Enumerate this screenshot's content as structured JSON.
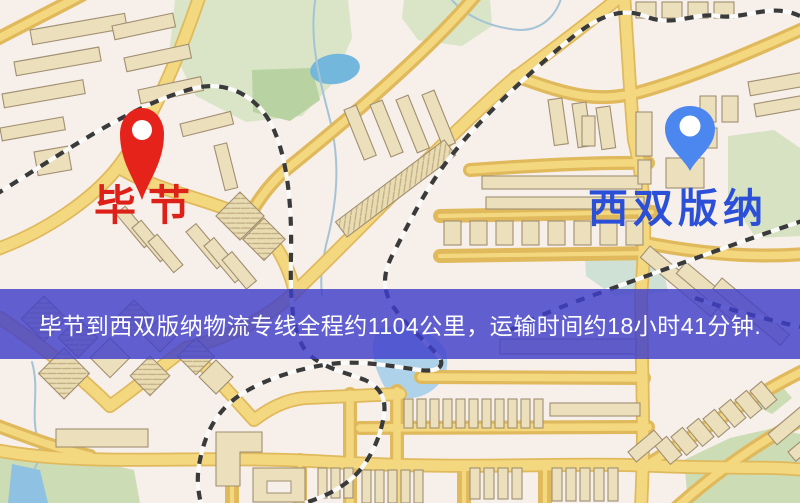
{
  "map": {
    "type": "road-map-screenshot",
    "banner": {
      "text": "毕节到西双版纳物流专线全程约1104公里，运输时间约18小时41分钟."
    },
    "markers": [
      {
        "id": "origin",
        "label": "毕节",
        "pin_icon": "red-map-pin"
      },
      {
        "id": "destination",
        "label": "西双版纳",
        "pin_icon": "blue-map-pin"
      }
    ],
    "css_vars": {
      "map-bg": "#f7efe9",
      "banner-bg": "rgba(64,62,202,0.82)",
      "banner-text": "#ffffff",
      "label-origin": "#dd2018",
      "label-destination": "#2b4fd6",
      "pin-origin": "#e6231b",
      "pin-destination": "#4c86ef",
      "road-fill": "#f3d87f",
      "road-casing": "#e0b95c",
      "building-fill": "#ebdfbc",
      "building-stroke": "#a08f72",
      "park": "#d9e5c6",
      "park-dark": "#b9d2a2",
      "water": "#74b7dc",
      "rail-dark": "#3a3a3a",
      "rail-light": "#fafaf8"
    }
  }
}
